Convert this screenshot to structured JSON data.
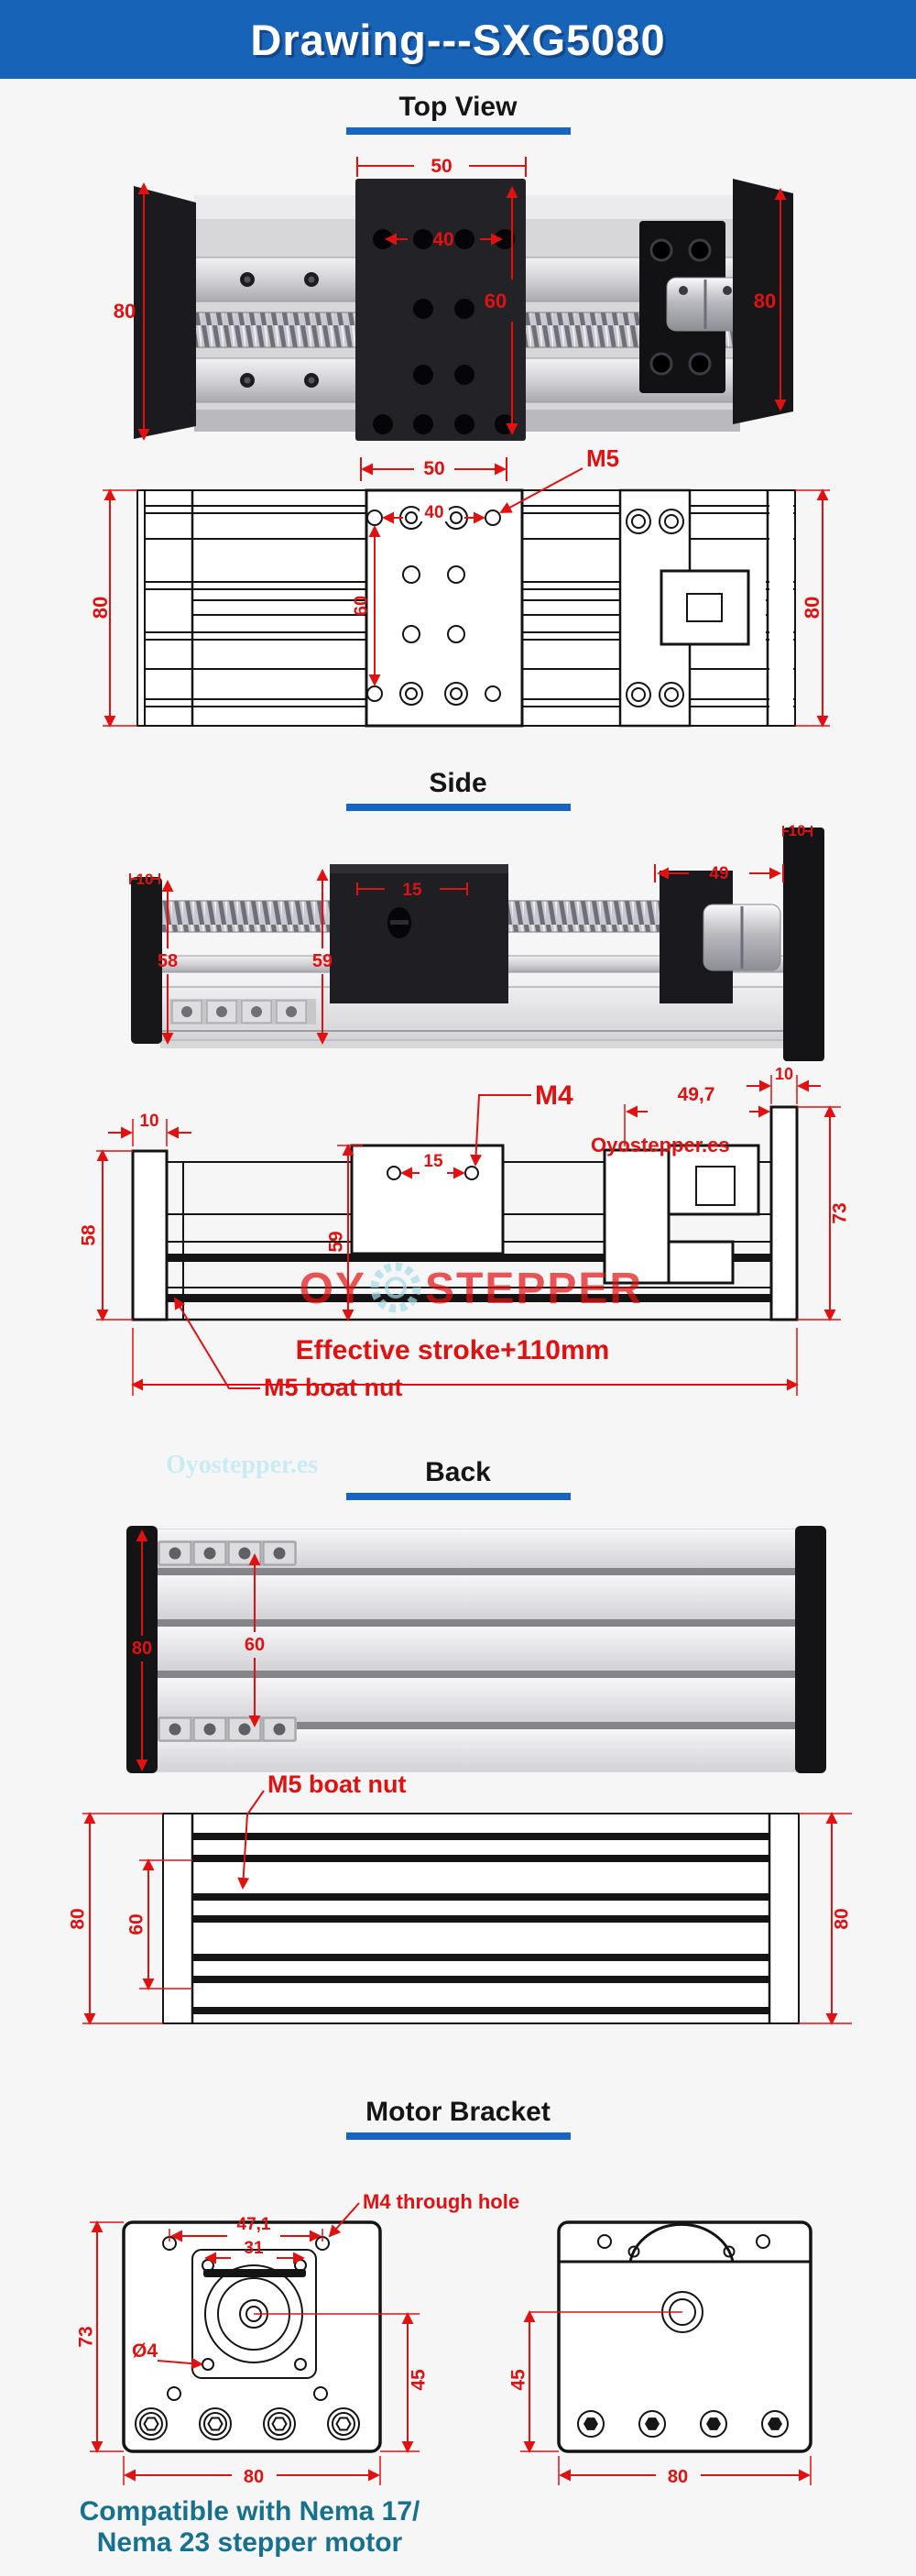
{
  "header": {
    "title": "Drawing---SXG5080"
  },
  "headings": {
    "top_view": "Top View",
    "side": "Side",
    "back": "Back",
    "motor_bracket": "Motor Bracket"
  },
  "colors": {
    "header_bg": "#1763b8",
    "heading_underline": "#1565c4",
    "dimension_red": "#e01111",
    "watermark_cyan": "#c9ebf3",
    "footer_teal": "#17718c"
  },
  "watermarks": {
    "site": "Oyostepper.es",
    "logo_left": "OY",
    "logo_right": "STEPPER"
  },
  "top_view": {
    "photo": {
      "dim_width_50": "50",
      "dim_holes_40": "40",
      "dim_height_80_left": "80",
      "dim_center_60": "60",
      "dim_height_80_right": "80"
    },
    "cad": {
      "dim_width_50": "50",
      "label_m5": "M5",
      "dim_holes_40": "40",
      "dim_center_60": "60",
      "dim_height_80_left": "80",
      "dim_height_80_right": "80"
    }
  },
  "side_view": {
    "photo": {
      "dim_left_10": "10",
      "dim_holes_15": "15",
      "dim_height_58": "58",
      "dim_height_59": "59",
      "dim_right_49": "49",
      "dim_right_10": "10"
    },
    "cad": {
      "dim_left_10": "10",
      "dim_holes_15": "15",
      "label_m4": "M4",
      "dim_right_49_7": "49,7",
      "dim_right_10": "10",
      "dim_height_58": "58",
      "dim_height_59": "59",
      "dim_height_73": "73",
      "label_stroke": "Effective stroke+110mm",
      "label_boat_nut": "M5 boat nut"
    }
  },
  "back_view": {
    "photo": {
      "dim_height_80": "80",
      "dim_nuts_60": "60"
    },
    "cad": {
      "label_boat_nut": "M5 boat nut",
      "dim_height_80_left": "80",
      "dim_nuts_60": "60",
      "dim_height_80_right": "80"
    }
  },
  "motor_bracket": {
    "front": {
      "label_m4_hole": "M4 through hole",
      "dim_holes_47_1": "47,1",
      "dim_holes_31": "31",
      "dim_height_73": "73",
      "dim_dia_4": "Ø4",
      "dim_center_45": "45",
      "dim_width_80": "80"
    },
    "side": {
      "dim_center_45": "45",
      "dim_width_80": "80"
    }
  },
  "footer": {
    "line1": "Compatible with Nema 17/",
    "line2": "Nema 23 stepper motor"
  }
}
